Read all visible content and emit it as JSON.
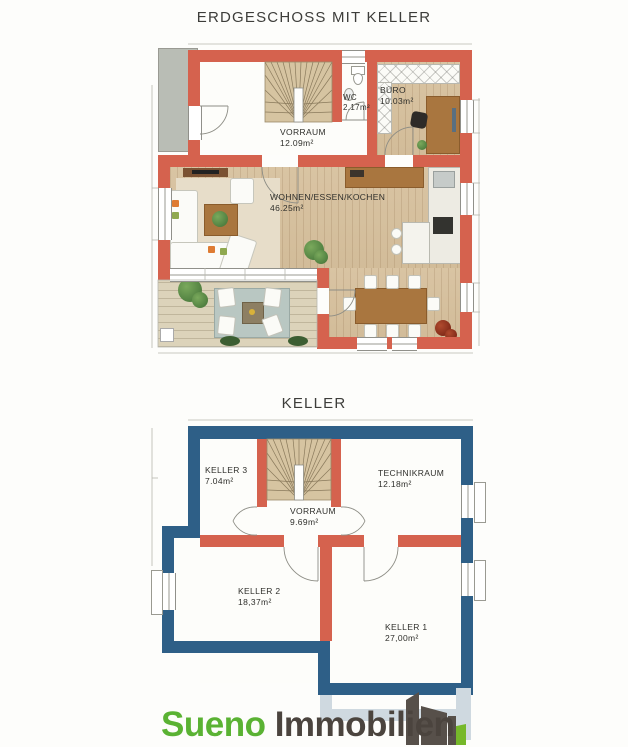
{
  "titles": {
    "ground_floor": "ERDGESCHOSS MIT KELLER",
    "basement": "KELLER"
  },
  "ground_floor": {
    "rooms": [
      {
        "name": "VORRAUM",
        "area": "12.09m²"
      },
      {
        "name": "WC",
        "area": "2.17m²"
      },
      {
        "name": "BÜRO",
        "area": "10.03m²"
      },
      {
        "name": "WOHNEN/ESSEN/KOCHEN",
        "area": "46.25m²"
      }
    ]
  },
  "basement": {
    "rooms": [
      {
        "name": "KELLER 3",
        "area": "7.04m²"
      },
      {
        "name": "TECHNIKRAUM",
        "area": "12.18m²"
      },
      {
        "name": "VORRAUM",
        "area": "9.69m²"
      },
      {
        "name": "KELLER 2",
        "area": "18,37m²"
      },
      {
        "name": "KELLER 1",
        "area": "27,00m²"
      }
    ]
  },
  "logo": {
    "brand_first": "Sueno",
    "brand_second": "Immobilien"
  },
  "colors": {
    "wall_red": "#d5624e",
    "wall_blue": "#2e5f87",
    "wood_floor": "#d9c4a3",
    "terrace_deck": "#dcd3ba",
    "stair_tread": "#d6c4a1",
    "canopy_gray": "#b9bdb5",
    "logo_green": "#5ab233",
    "logo_dark": "#4b443e",
    "logo_frame": "#cfd9e0"
  }
}
